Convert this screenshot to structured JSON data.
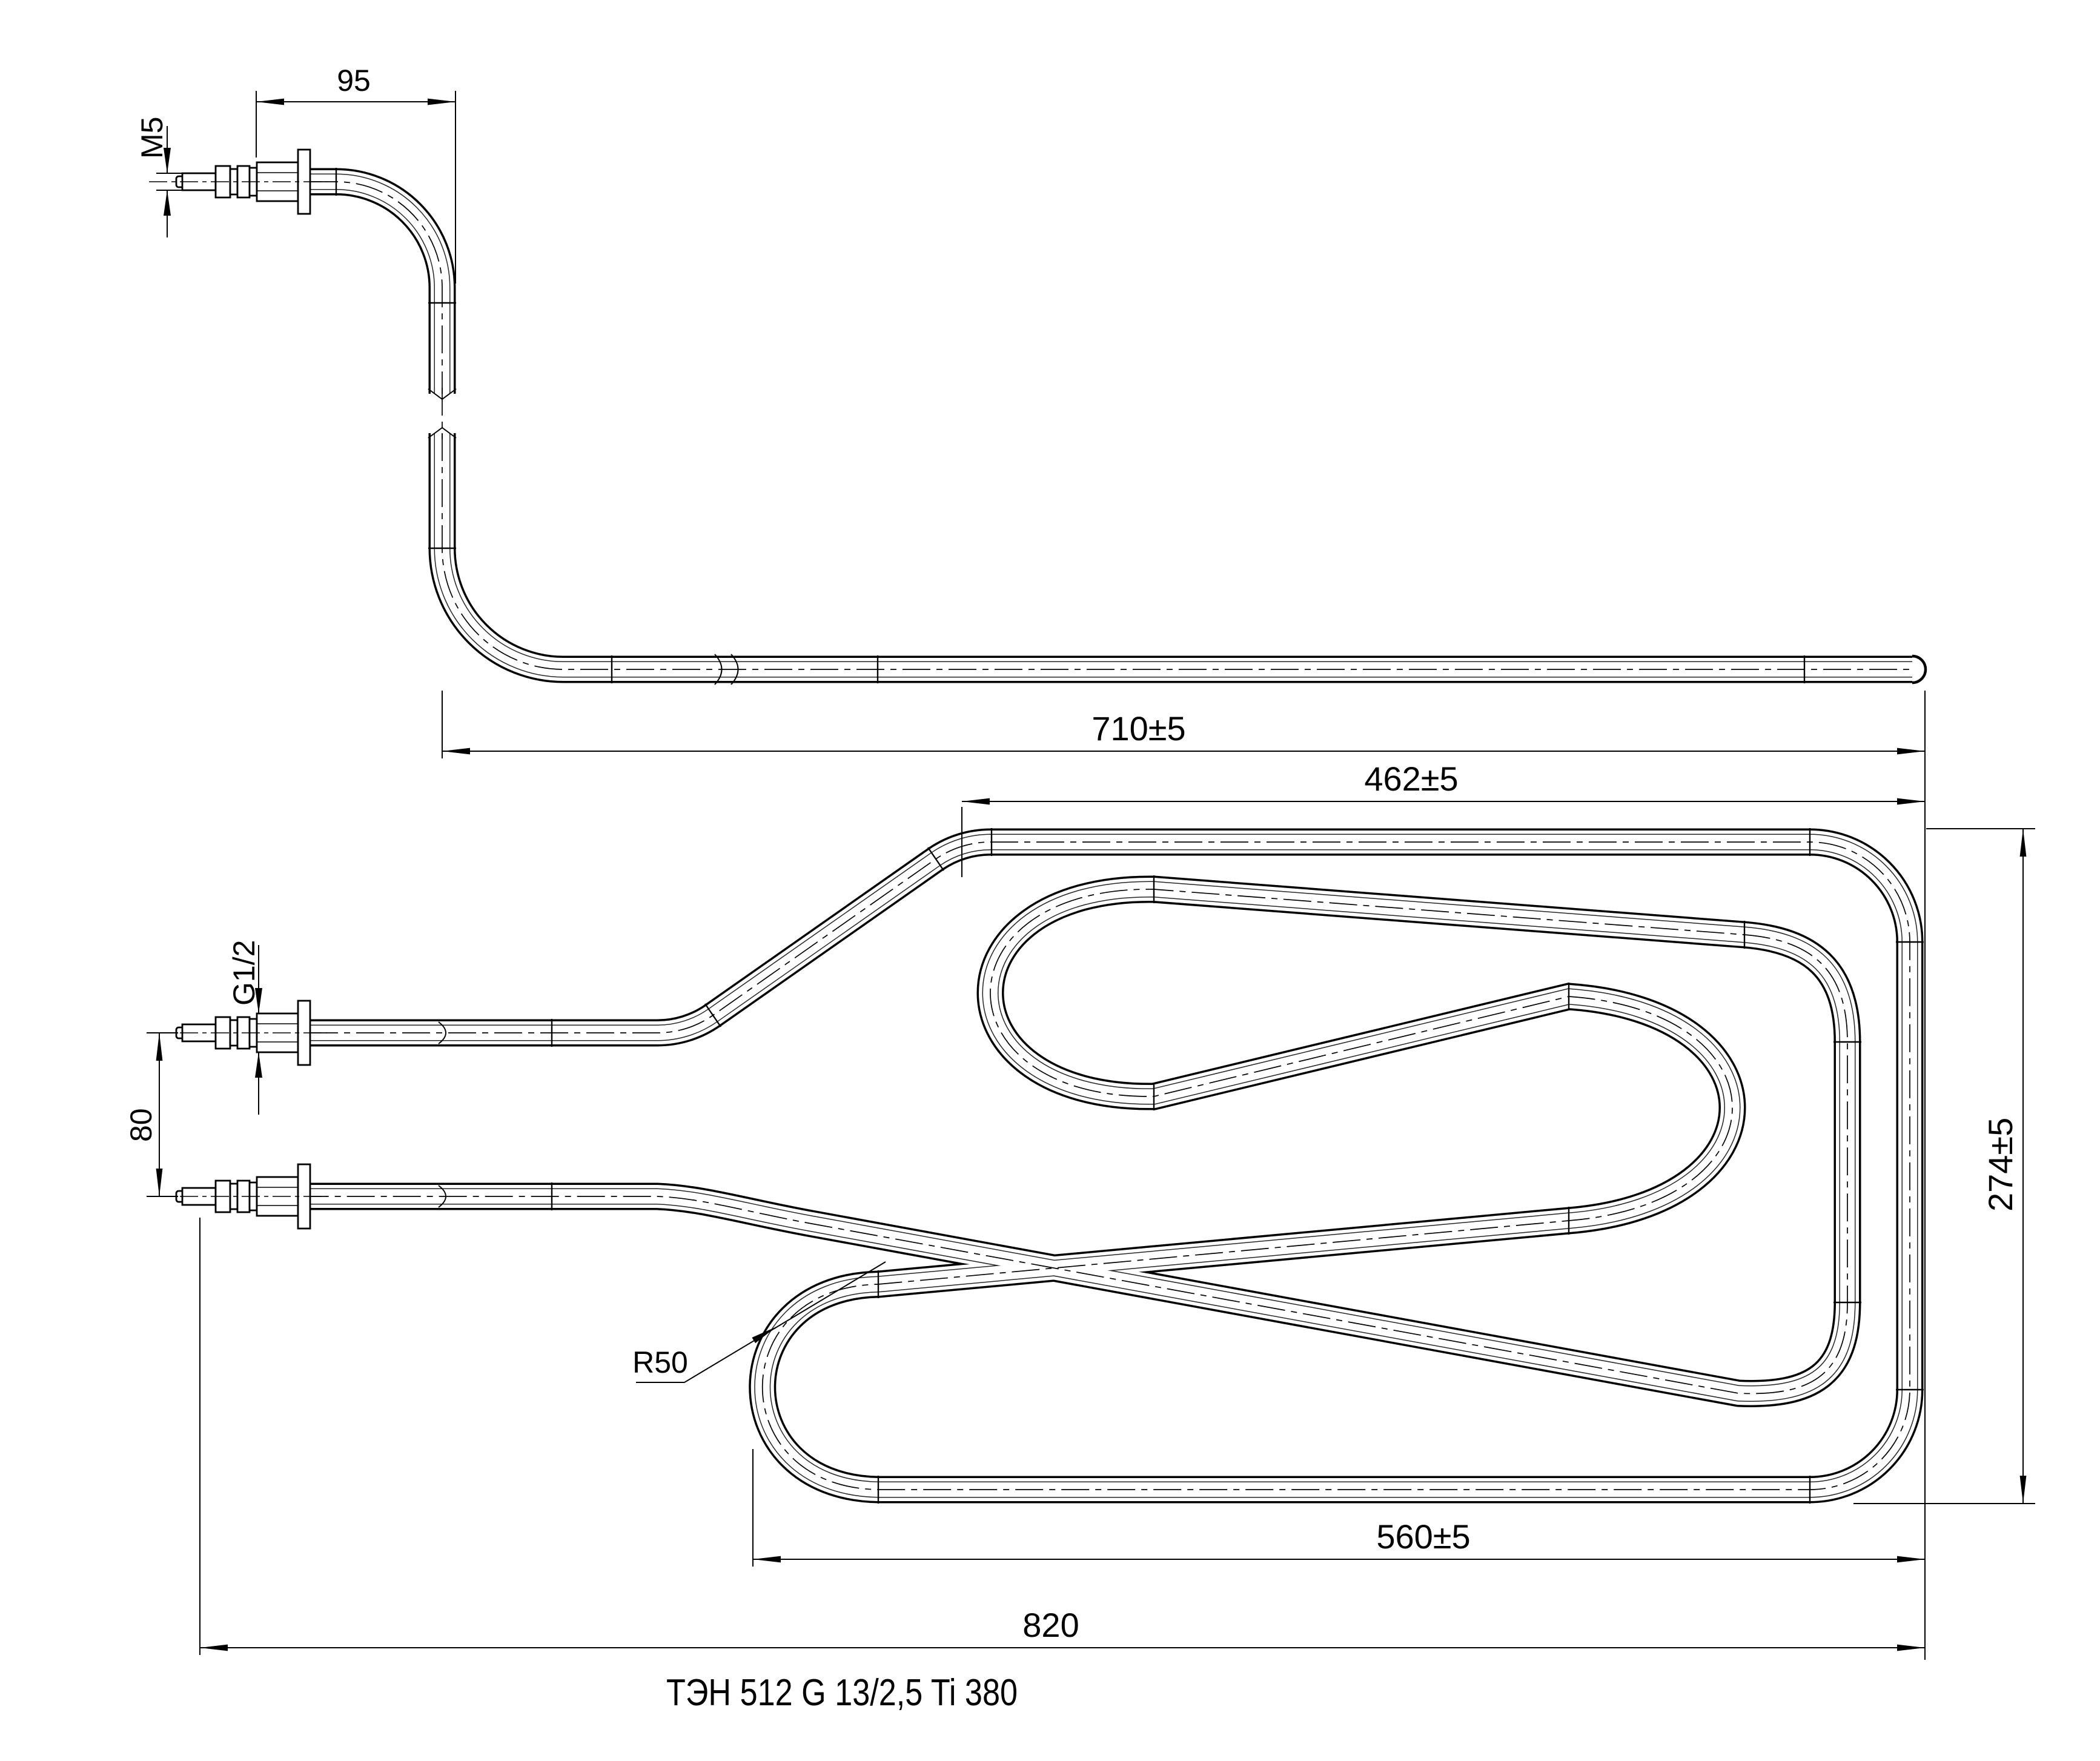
{
  "drawing": {
    "type": "engineering-drawing",
    "caption": "ТЭН 512 G 13/2,5 Ti 380",
    "line_color": "#000000",
    "background": "#ffffff",
    "views": {
      "side_view": "bent tubular heater end with terminal fitting",
      "plan_view": "serpentine heating coil with two threaded terminals"
    },
    "dimensions": {
      "terminal_offset": "95",
      "stud_thread": "M5",
      "leg_length": "710±5",
      "coil_top_width": "462±5",
      "coil_height": "274±5",
      "coil_bottom_width": "560±5",
      "overall_width": "820",
      "terminal_spacing": "80",
      "bushing_thread": "G1/2",
      "bend_radius": "R50"
    }
  }
}
